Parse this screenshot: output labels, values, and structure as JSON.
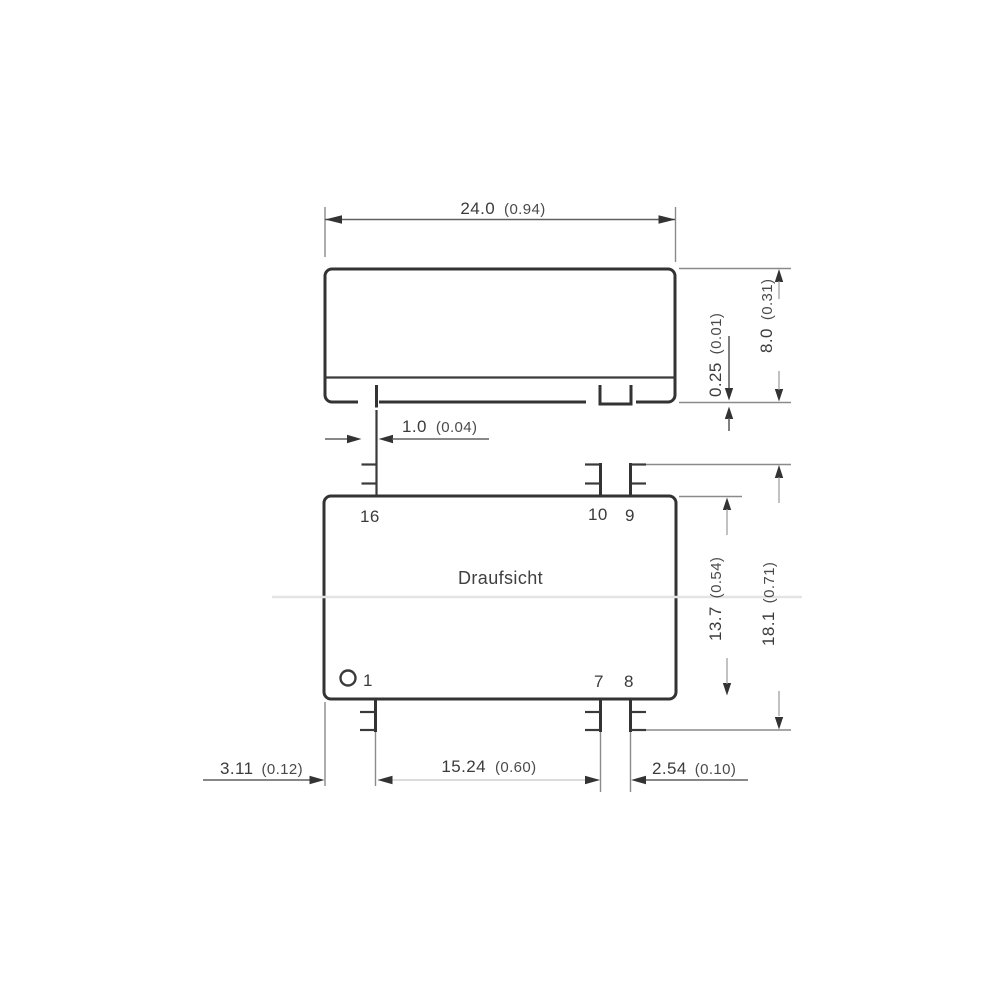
{
  "drawing": {
    "view_label": "Draufsicht",
    "pin_labels": {
      "pin16": "16",
      "pin10": "10",
      "pin9": "9",
      "pin1": "1",
      "pin7": "7",
      "pin8": "8"
    },
    "dimensions": {
      "body_width": {
        "mm": "24.0",
        "inch": "(0.94)"
      },
      "standoff_height": {
        "mm": "0.25",
        "inch": "(0.01)"
      },
      "body_height": {
        "mm": "8.0",
        "inch": "(0.31)"
      },
      "pin_diameter": {
        "mm": "1.0",
        "inch": "(0.04)"
      },
      "body_depth": {
        "mm": "13.7",
        "inch": "(0.54)"
      },
      "overall_depth": {
        "mm": "18.1",
        "inch": "(0.71)"
      },
      "pin1_edge_offset": {
        "mm": "3.11",
        "inch": "(0.12)"
      },
      "pin_row_spacing": {
        "mm": "15.24",
        "inch": "(0.60)"
      },
      "pin_pitch": {
        "mm": "2.54",
        "inch": "(0.10)"
      }
    },
    "colors": {
      "line": "#333333",
      "text": "#3b3b3b",
      "background": "#ffffff"
    }
  }
}
